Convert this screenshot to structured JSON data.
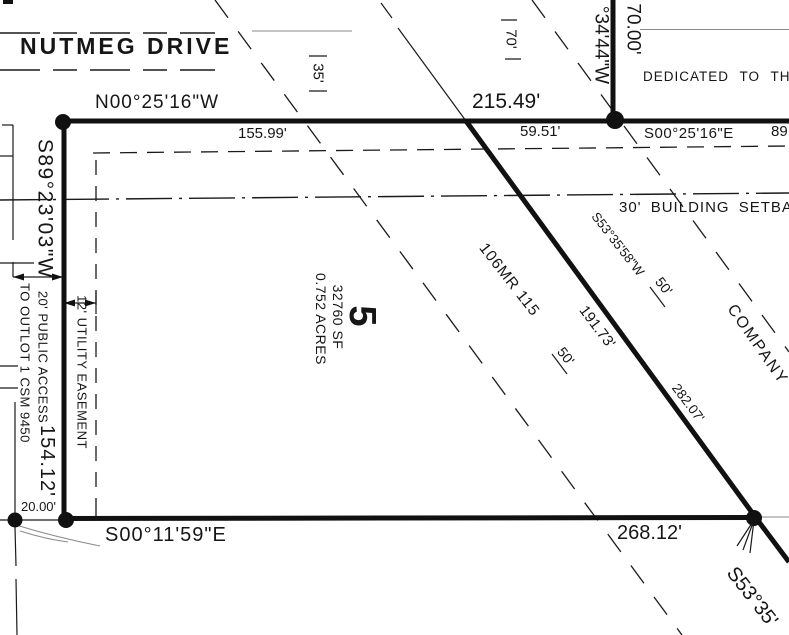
{
  "street": {
    "name": "NUTMEG DRIVE"
  },
  "lot5": {
    "number": "5",
    "sf": "32760 SF",
    "acres": "0.752 ACRES",
    "plat_ref": "106MR 115"
  },
  "north_line": {
    "bearing": "N00°25'16\"W",
    "total": "215.49'",
    "seg_a": "155.99'",
    "seg_b": "59.51'",
    "row_35": "35'"
  },
  "west_line": {
    "bearing": "S89°23'03\"W",
    "length": "154.12'"
  },
  "south_line": {
    "bearing": "S00°11'59\"E",
    "length": "268.12'",
    "tie": "20.00'"
  },
  "diagonal_line": {
    "bearing": "S53°35'58\"W",
    "length": "191.73'",
    "length_ne": "282.07'",
    "bearing_continued": "S53°35'",
    "offset_a": "50'",
    "offset_b": "50'"
  },
  "street_east": {
    "length": "70.00'",
    "bearing_partial": "°34'44\"W",
    "row_70": "70'",
    "dedication": "DEDICATED TO THE PUB",
    "adjacent_bearing": "S00°25'16\"E",
    "adjacent_dim_partial": "89"
  },
  "setback": {
    "label": "30' BUILDING SETBACK"
  },
  "easements": {
    "public_access": "20' PUBLIC ACCESS",
    "outlot": "TO OUTLOT 1 CSM 9450",
    "utility": "12' UTILITY EASEMENT",
    "company": "COMPANY"
  },
  "colors": {
    "ink": "#1a1a1a",
    "paper": "#ffffff",
    "faint": "#8a8a8a"
  }
}
